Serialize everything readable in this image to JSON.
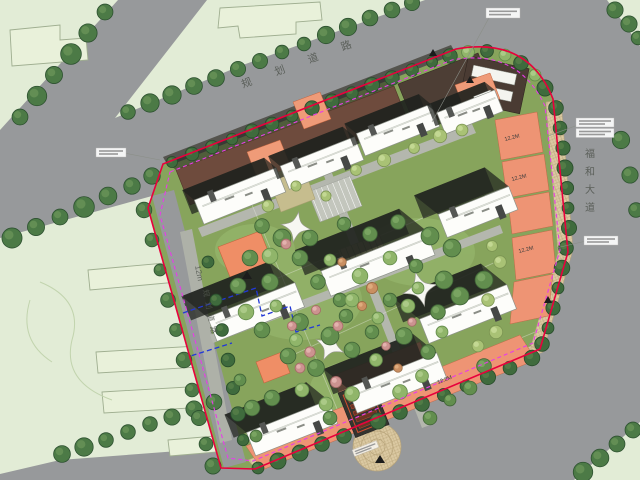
{
  "map": {
    "title": "residential-site-master-plan",
    "roads": {
      "top_road_name": "规 划 道 路",
      "right_road_name": "福和大道",
      "left_road_width": "12m",
      "left_road_name": "规划道路"
    },
    "annotations": {
      "height_labels": [
        "12.2M",
        "12.2M",
        "12.2M",
        "12.2M"
      ]
    },
    "colors": {
      "site_green": "#87a45c",
      "road_gray": "#97999b",
      "parcel_pale": "#e2ecd6",
      "commercial_salmon": "#ee9474",
      "podium_brown": "#6e4b3d",
      "boundary_red": "#e8003c",
      "setback_magenta": "#e83ce8",
      "utility_blue": "#2238d8",
      "paving_tan": "#dbc9a2"
    }
  }
}
